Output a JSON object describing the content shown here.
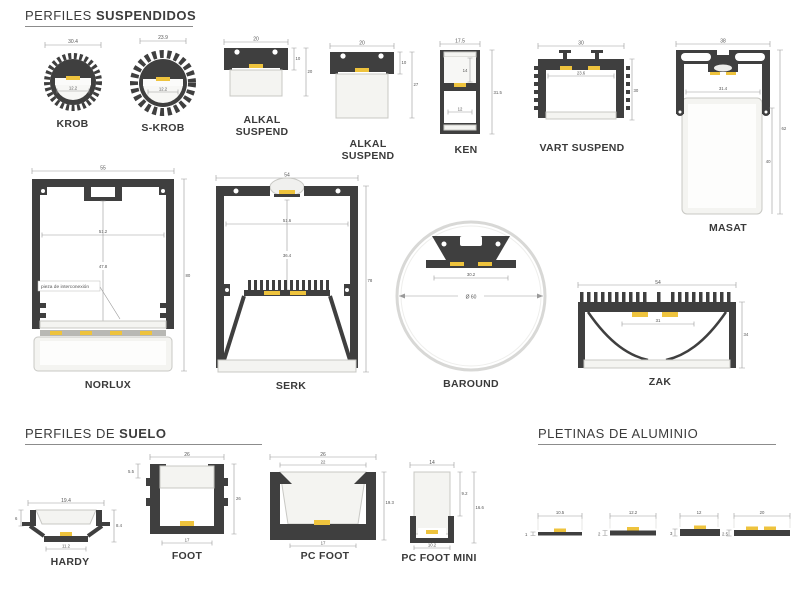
{
  "sections": {
    "suspended": {
      "prefix": "PERFILES",
      "emphasis": "SUSPENDIDOS"
    },
    "floor": {
      "prefix": "PERFILES DE",
      "emphasis": "SUELO"
    },
    "pletinas": {
      "prefix": "PLETINAS DE",
      "emphasis": "ALUMINIO"
    }
  },
  "profiles": {
    "krob": {
      "name": "KROB",
      "dims": {
        "width": "30.4",
        "inner": "12.2"
      }
    },
    "skrob": {
      "name": "S-KROB",
      "dims": {
        "width": "23.9",
        "inner": "12.2"
      }
    },
    "alkal1": {
      "name_line1": "ALKAL",
      "name_line2": "SUSPEND",
      "dims": {
        "width": "20",
        "body_height": "10",
        "total_height": "20"
      }
    },
    "alkal2": {
      "name_line1": "ALKAL",
      "name_line2": "SUSPEND",
      "dims": {
        "width": "20",
        "body_height": "10",
        "total_height": "27"
      }
    },
    "ken": {
      "name": "KEN",
      "dims": {
        "width": "17.5",
        "upper_height": "14",
        "inner_width": "12",
        "height": "31.5"
      }
    },
    "vart": {
      "name": "VART SUSPEND",
      "dims": {
        "width": "30",
        "inner_width": "23.6",
        "height": "30"
      }
    },
    "masat": {
      "name": "MASAT",
      "dims": {
        "width": "38",
        "inner_width": "31.4",
        "total_height": "62",
        "diffuser_height": "40"
      }
    },
    "norlux": {
      "name": "NORLUX",
      "annotation": "pieza de interconexión",
      "dims": {
        "width": "55",
        "inner_width": "51.2",
        "inner_height": "47.8",
        "height": "80"
      }
    },
    "serk": {
      "name": "SERK",
      "dims": {
        "width": "54",
        "inner_width": "51.6",
        "inner_height": "36.4",
        "height": "78"
      }
    },
    "baround": {
      "name": "BAROUND",
      "dims": {
        "diameter": "Ø 60",
        "inner_width": "30.2"
      }
    },
    "zak": {
      "name": "ZAK",
      "dims": {
        "width": "54",
        "inner_width": "31",
        "height": "34"
      }
    },
    "hardy": {
      "name": "HARDY",
      "dims": {
        "width": "19.4",
        "recess": "6",
        "height": "8.4",
        "bottom_width": "11.2"
      }
    },
    "foot": {
      "name": "FOOT",
      "dims": {
        "width": "26",
        "lip_height": "5.5",
        "height": "26",
        "bottom_width": "17"
      }
    },
    "pcfoot": {
      "name": "PC FOOT",
      "dims": {
        "outer_width": "26",
        "inner_width": "22",
        "height": "19.3",
        "bottom_width": "17"
      }
    },
    "pcfootmini": {
      "name": "PC FOOT MINI",
      "dims": {
        "width": "14",
        "inner_height": "9.2",
        "height": "16.6",
        "bottom_width": "10.2"
      }
    }
  },
  "pletinas": [
    {
      "width": "10.5",
      "thickness": "1"
    },
    {
      "width": "12.2",
      "thickness": "2"
    },
    {
      "width": "12",
      "thickness": "3"
    },
    {
      "width": "20",
      "thickness": "2.5"
    }
  ],
  "colors": {
    "profile_dark": "#3f3f3f",
    "diffuser_fill": "#f4f4f1",
    "diffuser_stroke": "#c8c8c4",
    "led_yellow": "#eec33d",
    "dim_line": "#9a9a9a",
    "dim_text": "#555555",
    "label_text": "#3a3a3a"
  }
}
